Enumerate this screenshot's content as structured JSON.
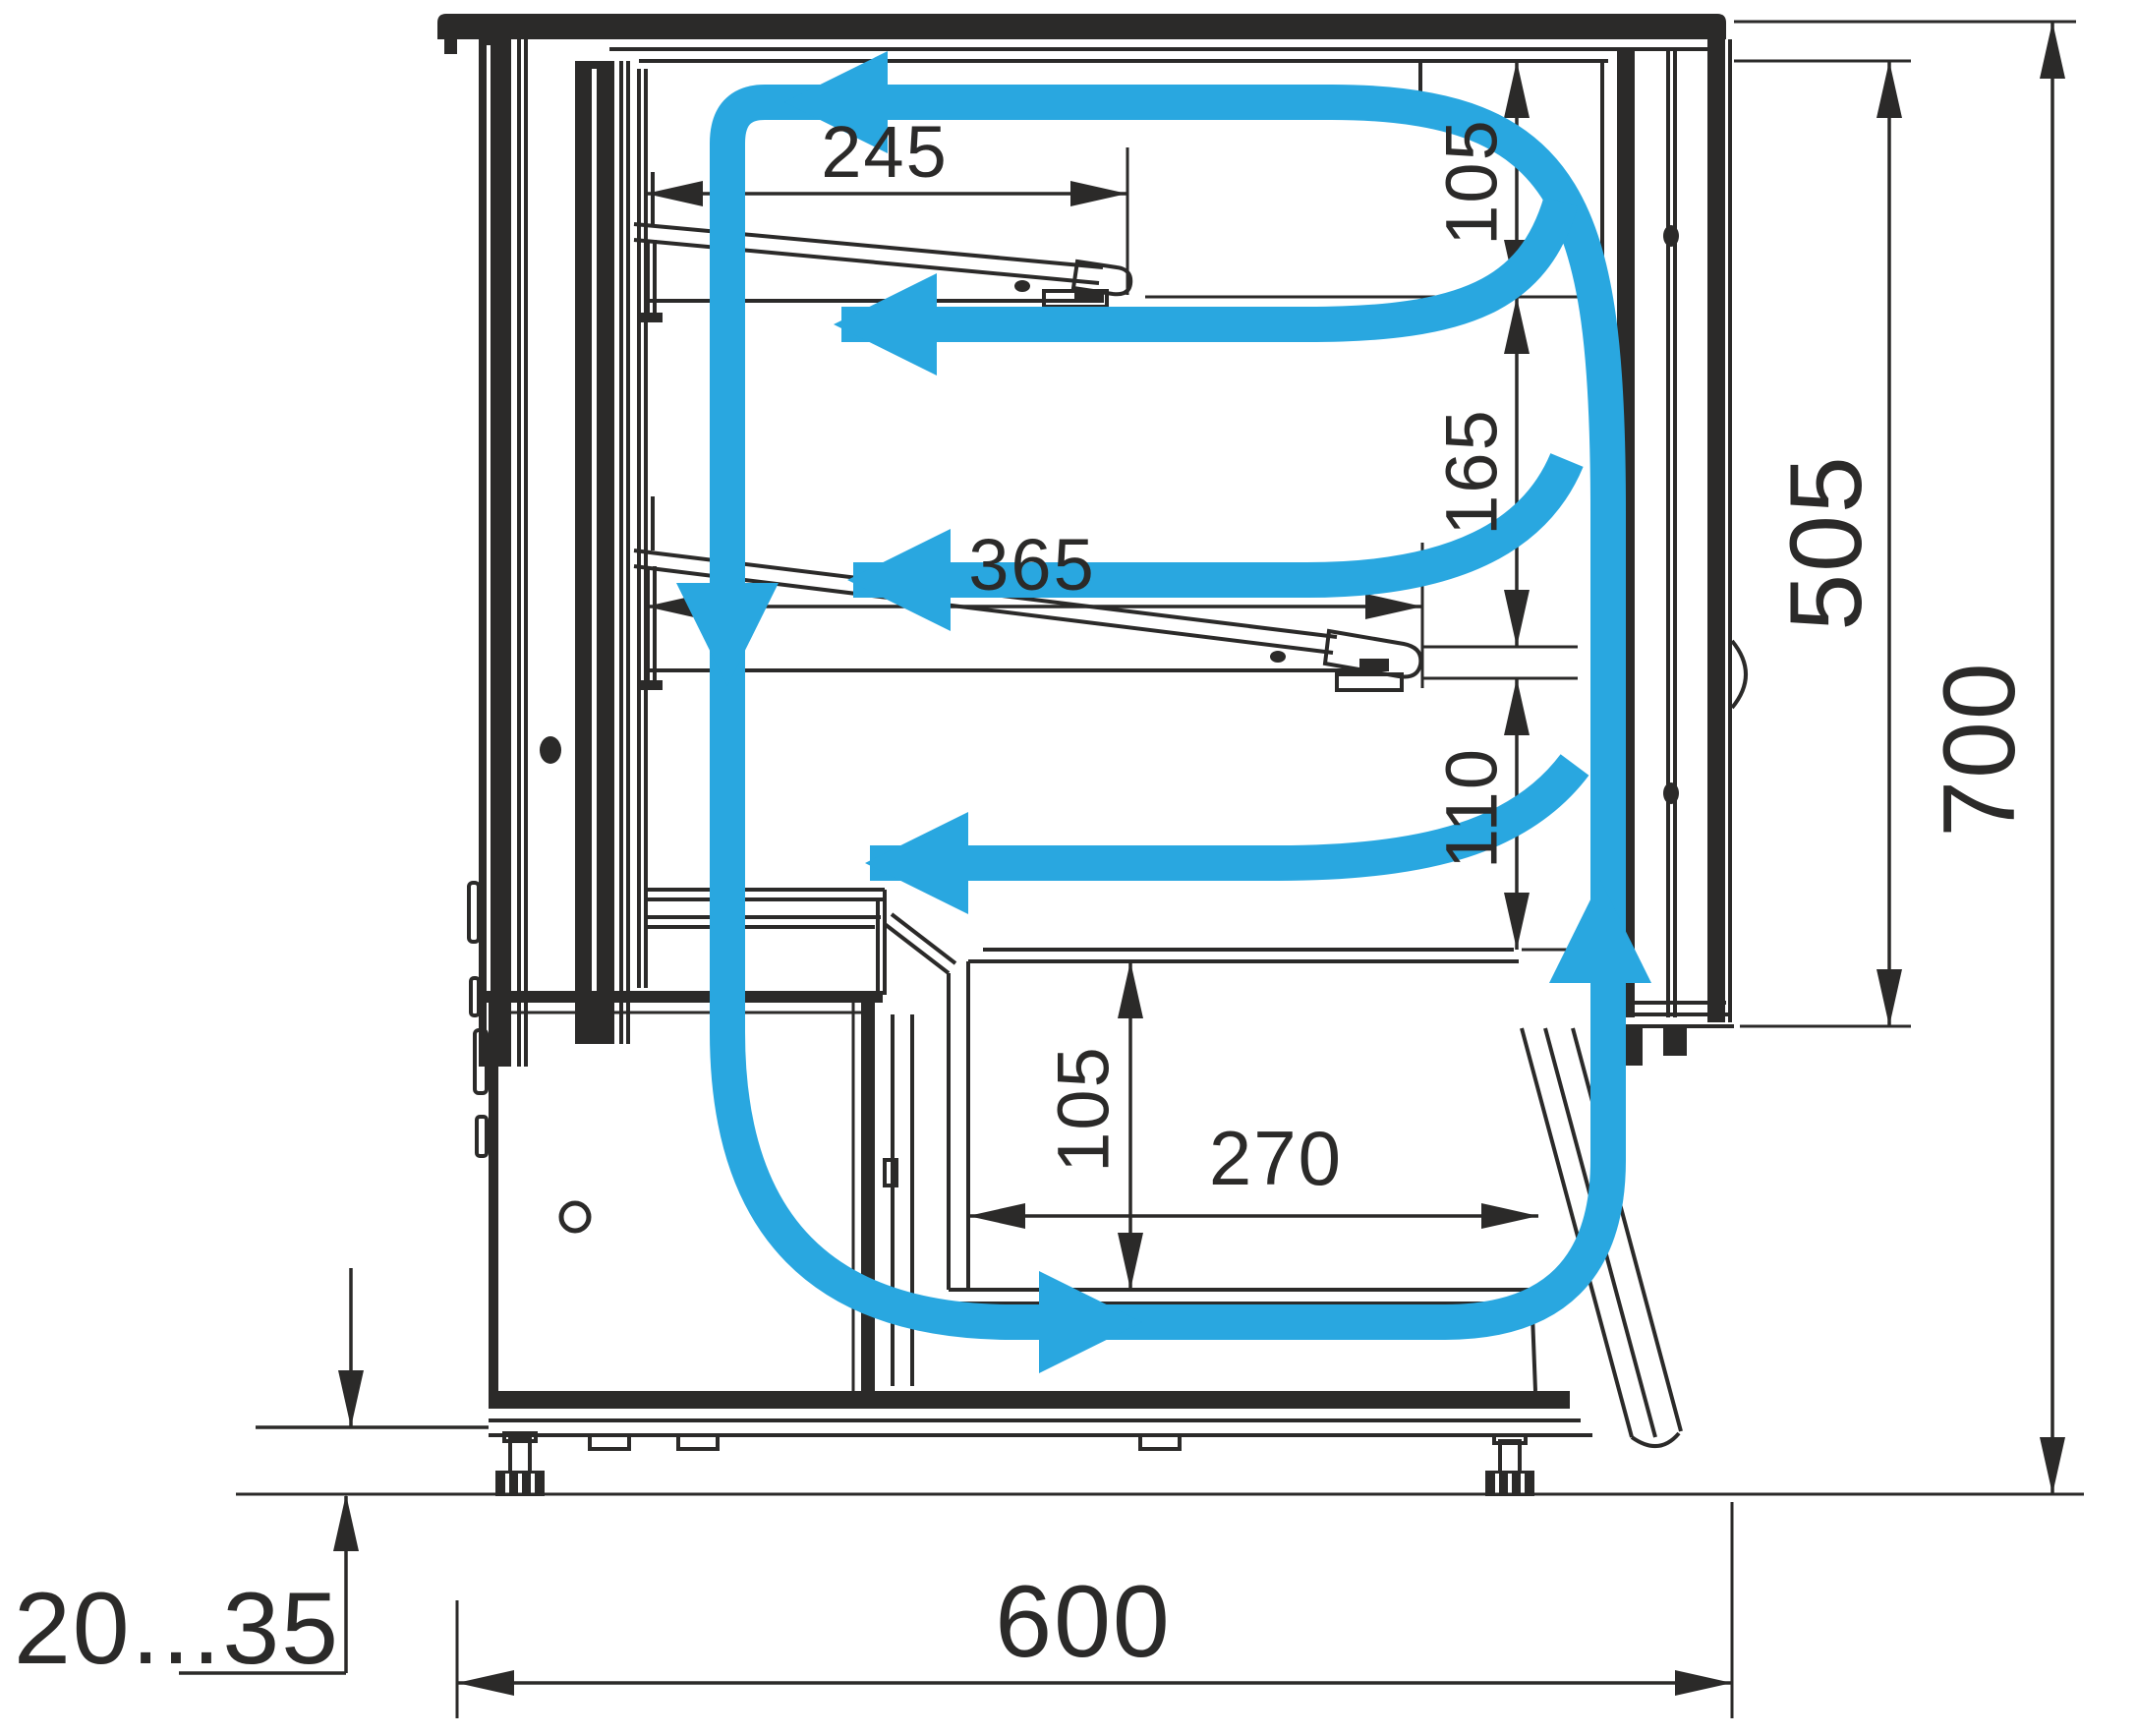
{
  "diagram": {
    "description": "Refrigerated display case side cross-section with air circulation arrows",
    "colors": {
      "line": "#2b2a29",
      "airflow": "#29a7e0",
      "background": "#ffffff"
    },
    "dimensions": {
      "upper_shelf_depth": "245",
      "top_clearance": "105",
      "lower_shelf_depth": "365",
      "shelf_clearance": "165",
      "deck_clearance": "110",
      "well_depth": "105",
      "well_length": "270",
      "display_opening_height": "505",
      "overall_height": "700",
      "overall_depth": "600",
      "leg_adjustment_range": "20...35"
    }
  }
}
